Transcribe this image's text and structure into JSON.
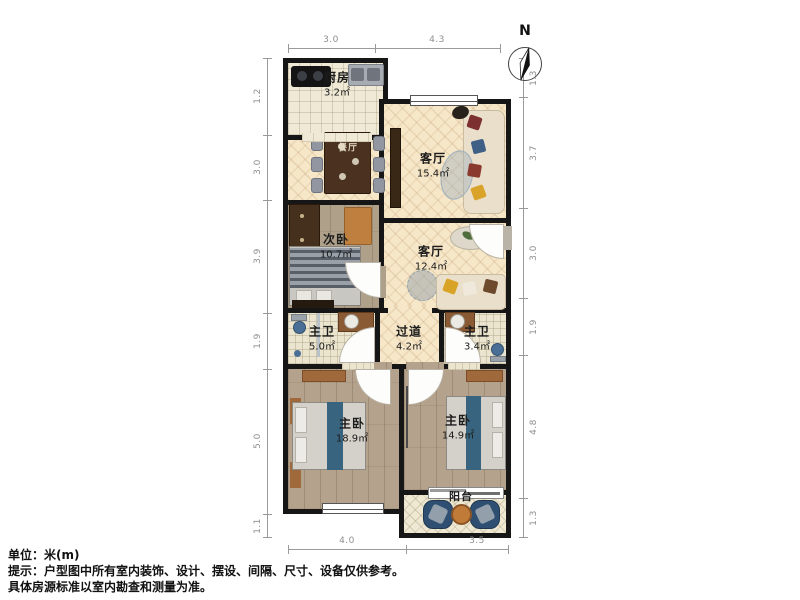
{
  "compass": {
    "label": "N"
  },
  "rooms": {
    "kitchen": {
      "name": "厨房",
      "area": "3.2㎡"
    },
    "living_main": {
      "name": "客厅",
      "area": "15.4㎡"
    },
    "dining": {
      "name": "餐厅"
    },
    "bedroom_second": {
      "name": "次卧",
      "area": "10.7㎡"
    },
    "living_second": {
      "name": "客厅",
      "area": "12.4㎡"
    },
    "bath_master": {
      "name": "主卫",
      "area": "5.0㎡"
    },
    "hallway": {
      "name": "过道",
      "area": "4.2㎡"
    },
    "bath_second": {
      "name": "主卫",
      "area": "3.4㎡"
    },
    "master_bedroom_left": {
      "name": "主卧",
      "area": "18.9㎡"
    },
    "master_bedroom_right": {
      "name": "主卧",
      "area": "14.9㎡"
    },
    "balcony": {
      "name": "阳台"
    }
  },
  "dimensions": {
    "top": [
      "3.0",
      "4.3"
    ],
    "bottom": [
      "4.0",
      "3.5"
    ],
    "left": [
      "1.2",
      "3.0",
      "3.9",
      "1.9",
      "5.0",
      "1.1"
    ],
    "right": [
      "1.3",
      "3.7",
      "3.0",
      "1.9",
      "4.8",
      "1.3"
    ]
  },
  "footer": {
    "unit": "单位：米(m)",
    "tip": "提示：户型图中所有室内装饰、设计、摆设、间隔、尺寸、设备仅供参考。",
    "note": "具体房源标准以室内勘查和测量为准。"
  },
  "colors": {
    "wall": "#161616",
    "parquet_floor": "#f6e7c9",
    "bedroom_floor": "#b4a28c",
    "accent_blue": "#38647f",
    "accent_orange": "#c07b39",
    "dim_text": "#8f8f8f"
  }
}
